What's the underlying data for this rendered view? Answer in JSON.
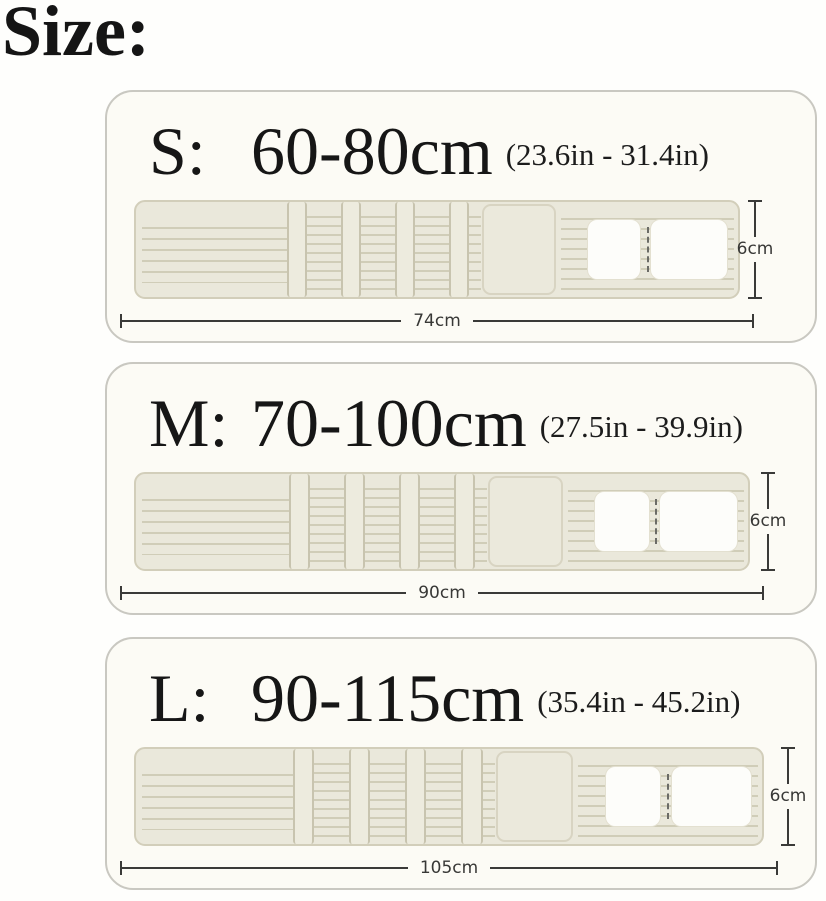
{
  "title": "Size:",
  "diagram_type": "product-size-chart",
  "sizes": [
    {
      "id": "S",
      "label": "S:",
      "range_cm": "60-80cm",
      "range_in": "(23.6in - 31.4in)",
      "belt_width_label": "74cm",
      "belt_height_label": "6cm"
    },
    {
      "id": "M",
      "label": "M:",
      "range_cm": "70-100cm",
      "range_in": "(27.5in - 39.9in)",
      "belt_width_label": "90cm",
      "belt_height_label": "6cm"
    },
    {
      "id": "L",
      "label": "L:",
      "range_cm": "90-115cm",
      "range_in": "(35.4in - 45.2in)",
      "belt_width_label": "105cm",
      "belt_height_label": "6cm"
    }
  ],
  "colors": {
    "page_background": "#fefefc",
    "card_background": "#fcfbf5",
    "card_border": "#c9c8c1",
    "belt_fill": "#eae8db",
    "belt_border": "#d2ceba",
    "belt_line": "#d0cdb8",
    "pocket_white": "#fdfdfa",
    "dimension_line": "#3a3a38",
    "text": "#151515"
  }
}
